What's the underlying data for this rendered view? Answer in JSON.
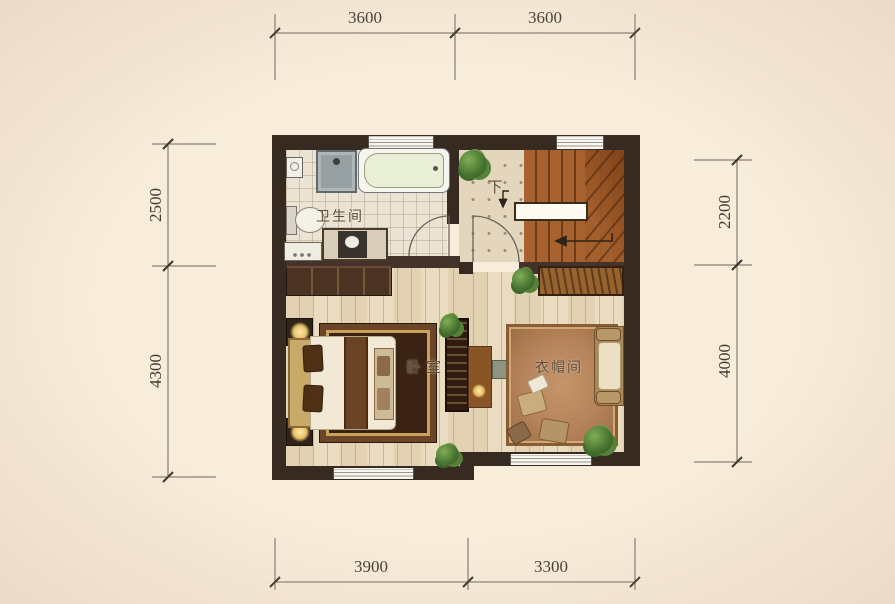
{
  "page": {
    "background_color": "#f8ecda"
  },
  "plan": {
    "rooms": {
      "bathroom": {
        "label": "卫生间"
      },
      "stairs": {
        "label": "下"
      },
      "bedroom": {
        "label": "卧室"
      },
      "cloakroom": {
        "label": "衣帽间"
      }
    },
    "colors": {
      "wall": "#362a21",
      "tile_floor": "#ebe4d4",
      "landing_floor": "#e4d6bc",
      "wood_floor": "#e9dcc0",
      "stair_wood": "#a8622f",
      "bed_rug": "#3a2312",
      "cloak_rug": "#b5835a",
      "bathtub": "#e9efd6",
      "window": "#f7f6f1"
    },
    "icons": [
      "plant-icon",
      "lamp-icon",
      "shower-head-icon",
      "bathtub-icon",
      "toilet-icon",
      "sink-icon",
      "washer-icon",
      "door-swing-icon",
      "stair-direction-arrow-icon",
      "down-arrow-icon"
    ]
  },
  "dimensions": {
    "top": [
      "3600",
      "3600"
    ],
    "bottom": [
      "3900",
      "3300"
    ],
    "left": [
      "2500",
      "4300"
    ],
    "right": [
      "2200",
      "4000"
    ]
  }
}
